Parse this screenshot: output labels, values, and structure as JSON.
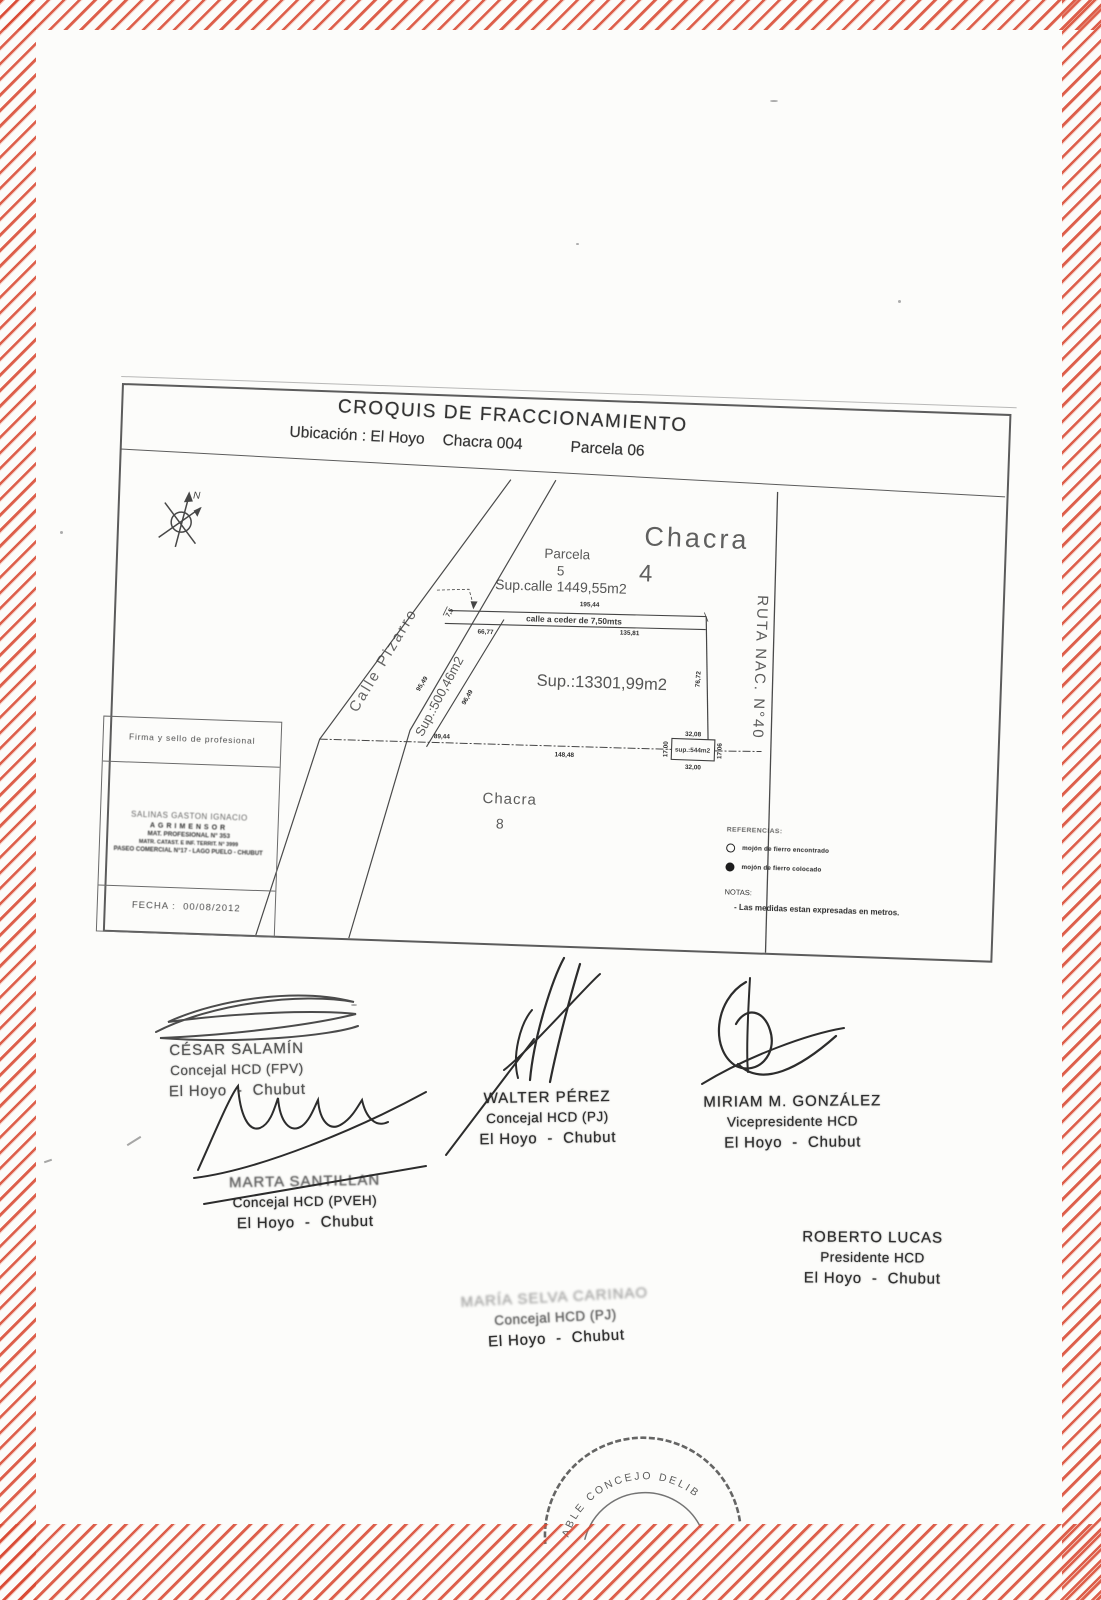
{
  "header": {
    "title": "CROQUIS DE FRACCIONAMIENTO",
    "location": "Ubicación : El Hoyo",
    "chacra": "Chacra 004",
    "parcela": "Parcela 06"
  },
  "plan": {
    "north": "N",
    "chacra_word": "Chacra",
    "chacra_num": "4",
    "parcela_word": "Parcela",
    "parcela_num": "5",
    "sup_calle": "Sup.calle  1449,55m2",
    "calle_ceder": "calle  a  ceder  de  7,50mts",
    "street": "Calle Pizarro",
    "ruta": "RUTA  NAC.  N°40",
    "main_sup": "Sup.:13301,99m2",
    "tri_sup": "Sup.:500,46m2",
    "sq_sup": "sup.:544m2",
    "chacra8_word": "Chacra",
    "chacra8_num": "8",
    "dims": {
      "top_total": "195,44",
      "top_left": "66,77",
      "top_right": "135,81",
      "right": "76,72",
      "bottom": "148,48",
      "bottom_left": "89,44",
      "side_a": "95,49",
      "side_b": "96,49",
      "width_note": "7,5",
      "sq_top": "32,08",
      "sq_bottom": "32,00",
      "sq_left": "17,00",
      "sq_right": "17,06"
    },
    "references": {
      "title": "REFERENCIAS:",
      "item1": "mojón de fierro encontrado",
      "item2": "mojón de fierro colocado",
      "notas": "NOTAS:",
      "note": "- Las medidas estan expresadas en metros."
    },
    "probox": {
      "header": "Firma y sello  de profesional",
      "stamp_line1": "SALINAS  GASTON  IGNACIO",
      "stamp_line2": "AGRIMENSOR",
      "stamp_line3": "MAT. PROFESIONAL  N° 353",
      "stamp_line4": "MATR. CATAST. E INF. TERRIT.  N° 3999",
      "stamp_line5": "PASEO COMERCIAL N°17 - LAGO PUELO - CHUBUT",
      "fecha": "FECHA :  00/08/2012"
    }
  },
  "signatures": [
    {
      "name": "CÉSAR SALAMÍN",
      "role": "Concejal HCD (FPV)",
      "place": "El Hoyo  -  Chubut"
    },
    {
      "name": "WALTER PÉREZ",
      "role": "Concejal HCD (PJ)",
      "place": "El Hoyo  -  Chubut"
    },
    {
      "name": "MIRIAM M. GONZÁLEZ",
      "role": "Vicepresidente HCD",
      "place": "El Hoyo  -  Chubut"
    },
    {
      "name": "MARTA SANTILLAN",
      "role": "Concejal HCD (PVEH)",
      "place": "El Hoyo  -  Chubut"
    },
    {
      "name": "ROBERTO LUCAS",
      "role": "Presidente HCD",
      "place": "El Hoyo  -  Chubut"
    },
    {
      "name": "MARÍA SELVA CARINAO",
      "role": "Concejal HCD (PJ)",
      "place": "El Hoyo  -  Chubut"
    }
  ],
  "bottom_stamp": {
    "arc_text": "ABLE CONCEJO DELIB"
  }
}
